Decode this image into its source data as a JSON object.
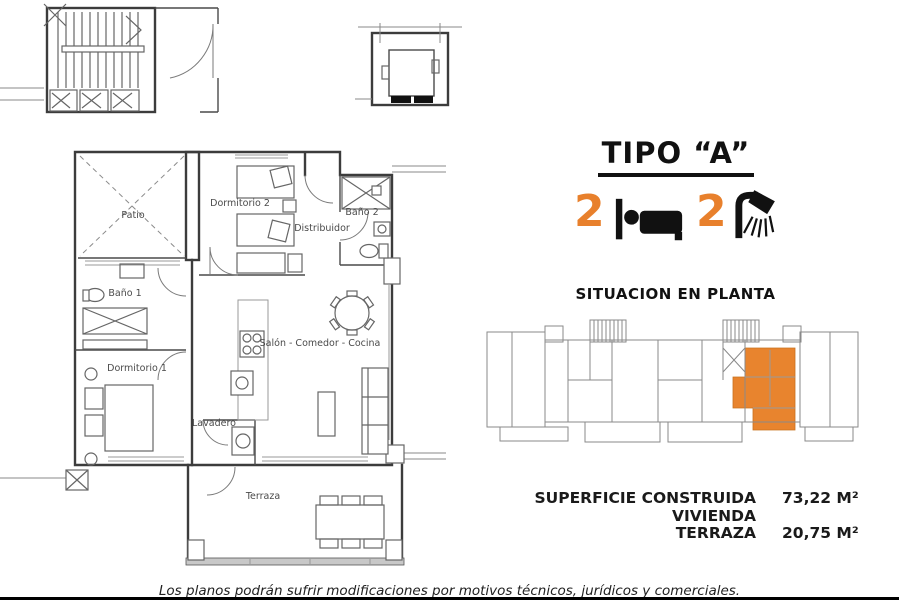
{
  "header": {
    "type_title": "TIPO “A”"
  },
  "features": {
    "bedrooms": "2",
    "bathrooms": "2"
  },
  "rooms": {
    "patio": "Patio",
    "dormitorio2": "Dormitorio 2",
    "bano2": "Baño 2",
    "distribuidor": "Distribuidor",
    "bano1": "Baño 1",
    "dormitorio1": "Dormitorio 1",
    "salon": "Salón - Comedor - Cocina",
    "lavadero": "Lavadero",
    "terraza": "Terraza"
  },
  "situation": {
    "title": "SITUACION EN PLANTA"
  },
  "areas": {
    "vivienda_label": "SUPERFICIE CONSTRUIDA VIVIENDA",
    "vivienda_value": "73,22 M²",
    "terraza_label": "TERRAZA",
    "terraza_value": "20,75 M²"
  },
  "footer": {
    "disclaimer": "Los planos podrán sufrir modificaciones por motivos técnicos, jurídicos y comerciales."
  },
  "colors": {
    "accent_orange": "#E8802C",
    "wall_dark": "#3C3C3C",
    "line_gray": "#8A8A8A",
    "highlight_unit": "#E8842E"
  }
}
